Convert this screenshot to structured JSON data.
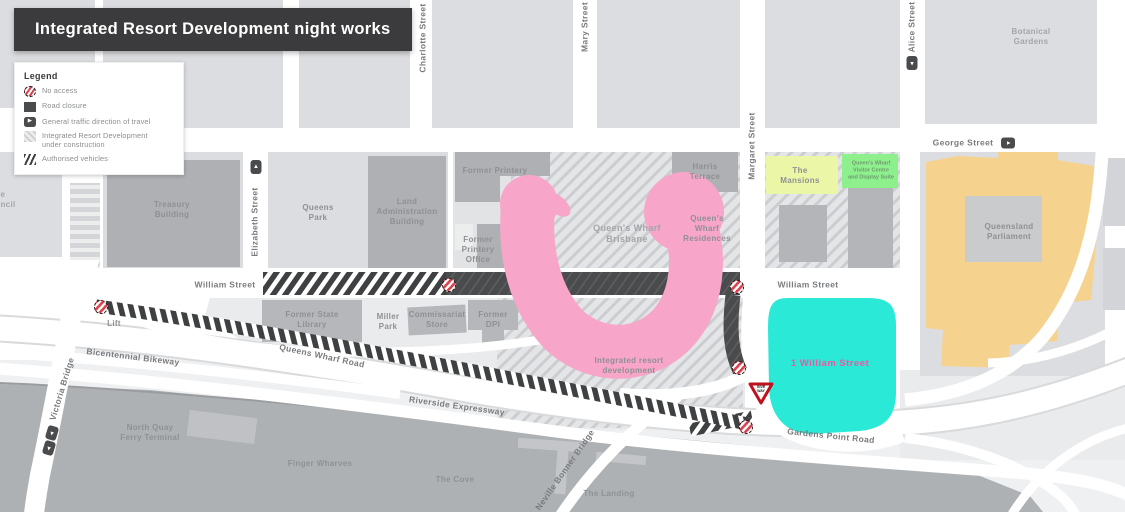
{
  "title": "Integrated Resort Development night works",
  "legend": {
    "heading": "Legend",
    "items": [
      {
        "label": "No access"
      },
      {
        "label": "Road closure"
      },
      {
        "label": "General traffic direction of travel"
      },
      {
        "label": "Integrated Resort Development\nunder construction"
      },
      {
        "label": "Authorised vehicles"
      }
    ]
  },
  "streets": {
    "charlotte": "Charlotte Street",
    "mary": "Mary Street",
    "margaret": "Margaret Street",
    "alice": "Alice Street",
    "elizabeth": "Elizabeth Street",
    "george": "George Street",
    "william_left": "William Street",
    "william_right": "William Street",
    "queens_wharf_road": "Queens Wharf Road",
    "riverside": "Riverside Expressway",
    "bikeway": "Bicentennial Bikeway",
    "victoria": "Victoria Bridge",
    "bonner": "Neville Bonner Bridge",
    "gardens_point": "Gardens Point Road"
  },
  "places": {
    "botanical": "Botanical\nGardens",
    "treasury": "Treasury\nBuilding",
    "queens_park": "Queens\nPark",
    "land_admin": "Land\nAdministration\nBuilding",
    "former_printery": "Former Printery",
    "printery_office": "Former\nPrintery\nOffice",
    "harris": "Harris\nTerrace",
    "qw_brisbane": "Queen's Wharf\nBrisbane",
    "qw_residences": "Queen's\nWharf\nResidences",
    "resort": "Integrated resort\ndevelopment",
    "mansions": "The\nMansions",
    "visitor_centre": "Queen's Wharf\nVisitor Centre\nand Display Suite",
    "parliament": "Queensland\nParliament",
    "one_william": "1 William Street",
    "north_quay": "North Quay\nFerry Terminal",
    "finger_wharves": "Finger Wharves",
    "cove": "The Cove",
    "landing": "The Landing",
    "lift": "Lift",
    "state_library": "Former State\nLibrary",
    "miller_park": "Miller\nPark",
    "commissariat": "Commissariat\nStore",
    "former_dpi": "Former\nDPI",
    "council_cut": "e\nncil",
    "give_way": "GIVE\nWAY"
  },
  "colors": {
    "banner": "#3b3b3d",
    "block": "#dcdde0",
    "building": "#aeb0b3",
    "river": "#aeb1b4",
    "road_closure": "#4a4b4d",
    "resort_pink": "#f7a6ca",
    "one_william_cyan": "#2ae9d7",
    "parliament_orange": "#f6d28f",
    "mansions_yellow": "#ebf7a6",
    "visitor_green": "#8ef08d",
    "no_access_red": "#d9414d"
  }
}
